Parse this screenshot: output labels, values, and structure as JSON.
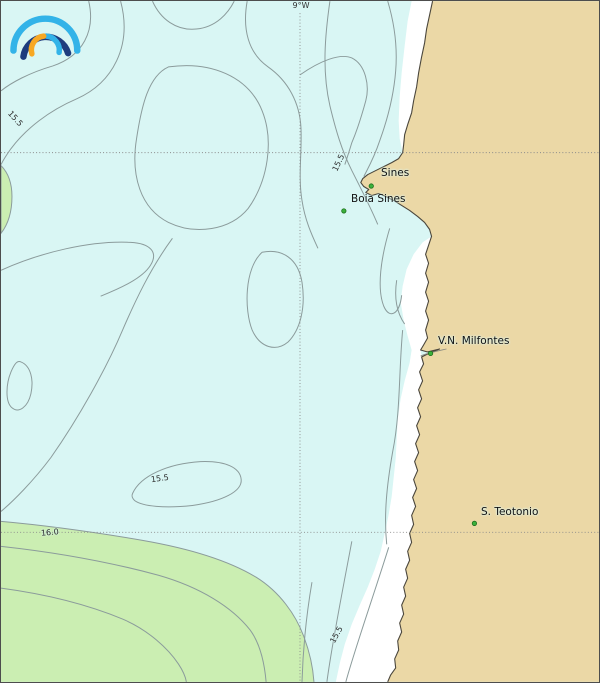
{
  "map": {
    "grid": {
      "meridian_label": "9°W"
    },
    "places": [
      {
        "name": "Sines"
      },
      {
        "name": "Boia Sines"
      },
      {
        "name": "V.N. Milfontes"
      },
      {
        "name": "S. Teotonio"
      }
    ],
    "contour_labels": [
      {
        "value": "15.5",
        "location": "upper-left"
      },
      {
        "value": "15.5",
        "location": "near-sines"
      },
      {
        "value": "15.5",
        "location": "lower-center"
      },
      {
        "value": "16.0",
        "location": "lower-left"
      },
      {
        "value": "15.5",
        "location": "lower-right"
      }
    ],
    "isolines": [
      "15.5",
      "16.0"
    ],
    "colors": {
      "ocean": "#d9f6f4",
      "land": "#ebd8a6",
      "warm_band_green": "#cbeeb2",
      "nearshore_band": "#ffffff",
      "contour_line": "#8b9b9b",
      "coastline": "#4a463c",
      "grid_line": "#8a8a8a",
      "place_marker": "#3cb13c",
      "label_text": "#111111",
      "logo_light_blue": "#33b3e8",
      "logo_navy": "#1e3c7e",
      "logo_orange": "#f7a823"
    },
    "logo": {
      "name": "ipma-rainbow-logo"
    }
  }
}
